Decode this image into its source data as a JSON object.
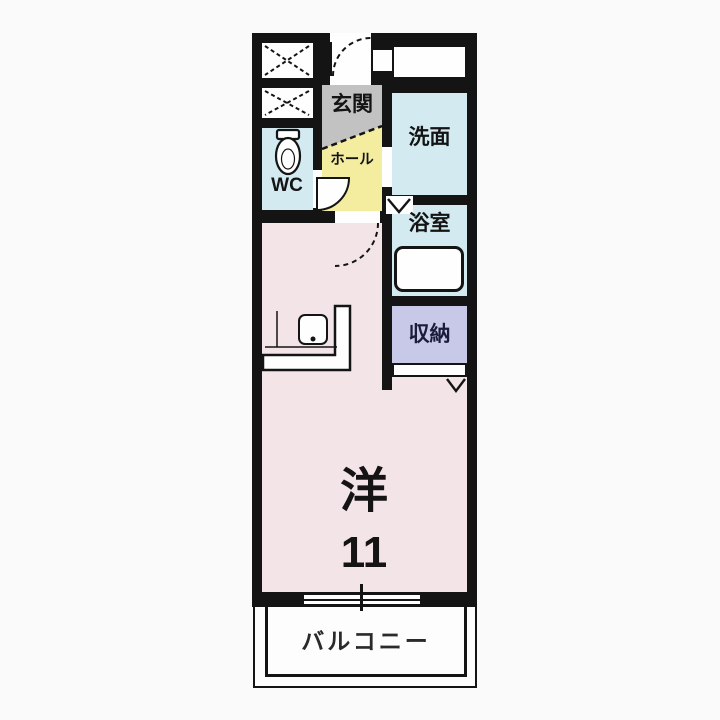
{
  "plan": {
    "type": "apartment-floor-plan",
    "rooms": {
      "entrance": {
        "label": "玄関"
      },
      "hall": {
        "label": "ホール"
      },
      "toilet": {
        "label": "WC"
      },
      "washroom": {
        "label": "洗面"
      },
      "bathroom": {
        "label": "浴室"
      },
      "storage": {
        "label": "収納"
      },
      "western_room": {
        "label": "洋",
        "size": "11"
      },
      "balcony": {
        "label": "バルコニー"
      }
    },
    "fixtures": [
      "toilet-icon",
      "bathtub-icon",
      "kitchen-counter-icon",
      "kitchen-sink-icon",
      "entrance-door-swing-icon",
      "wc-door-swing-icon",
      "room-door-swing-icon",
      "folding-door-arrow-icon",
      "closet-door-arrow-icon",
      "sliding-window-icon",
      "duct-x-icon"
    ],
    "colors": {
      "wall": "#141414",
      "main_room": "#f3e4e8",
      "hall": "#f4eda0",
      "entrance": "#c2c2c2",
      "wet_rooms": "#d2eaf0",
      "storage": "#c8c8e8",
      "balcony": "#fdfdfd",
      "storage_text": "#1b1b3a"
    }
  }
}
